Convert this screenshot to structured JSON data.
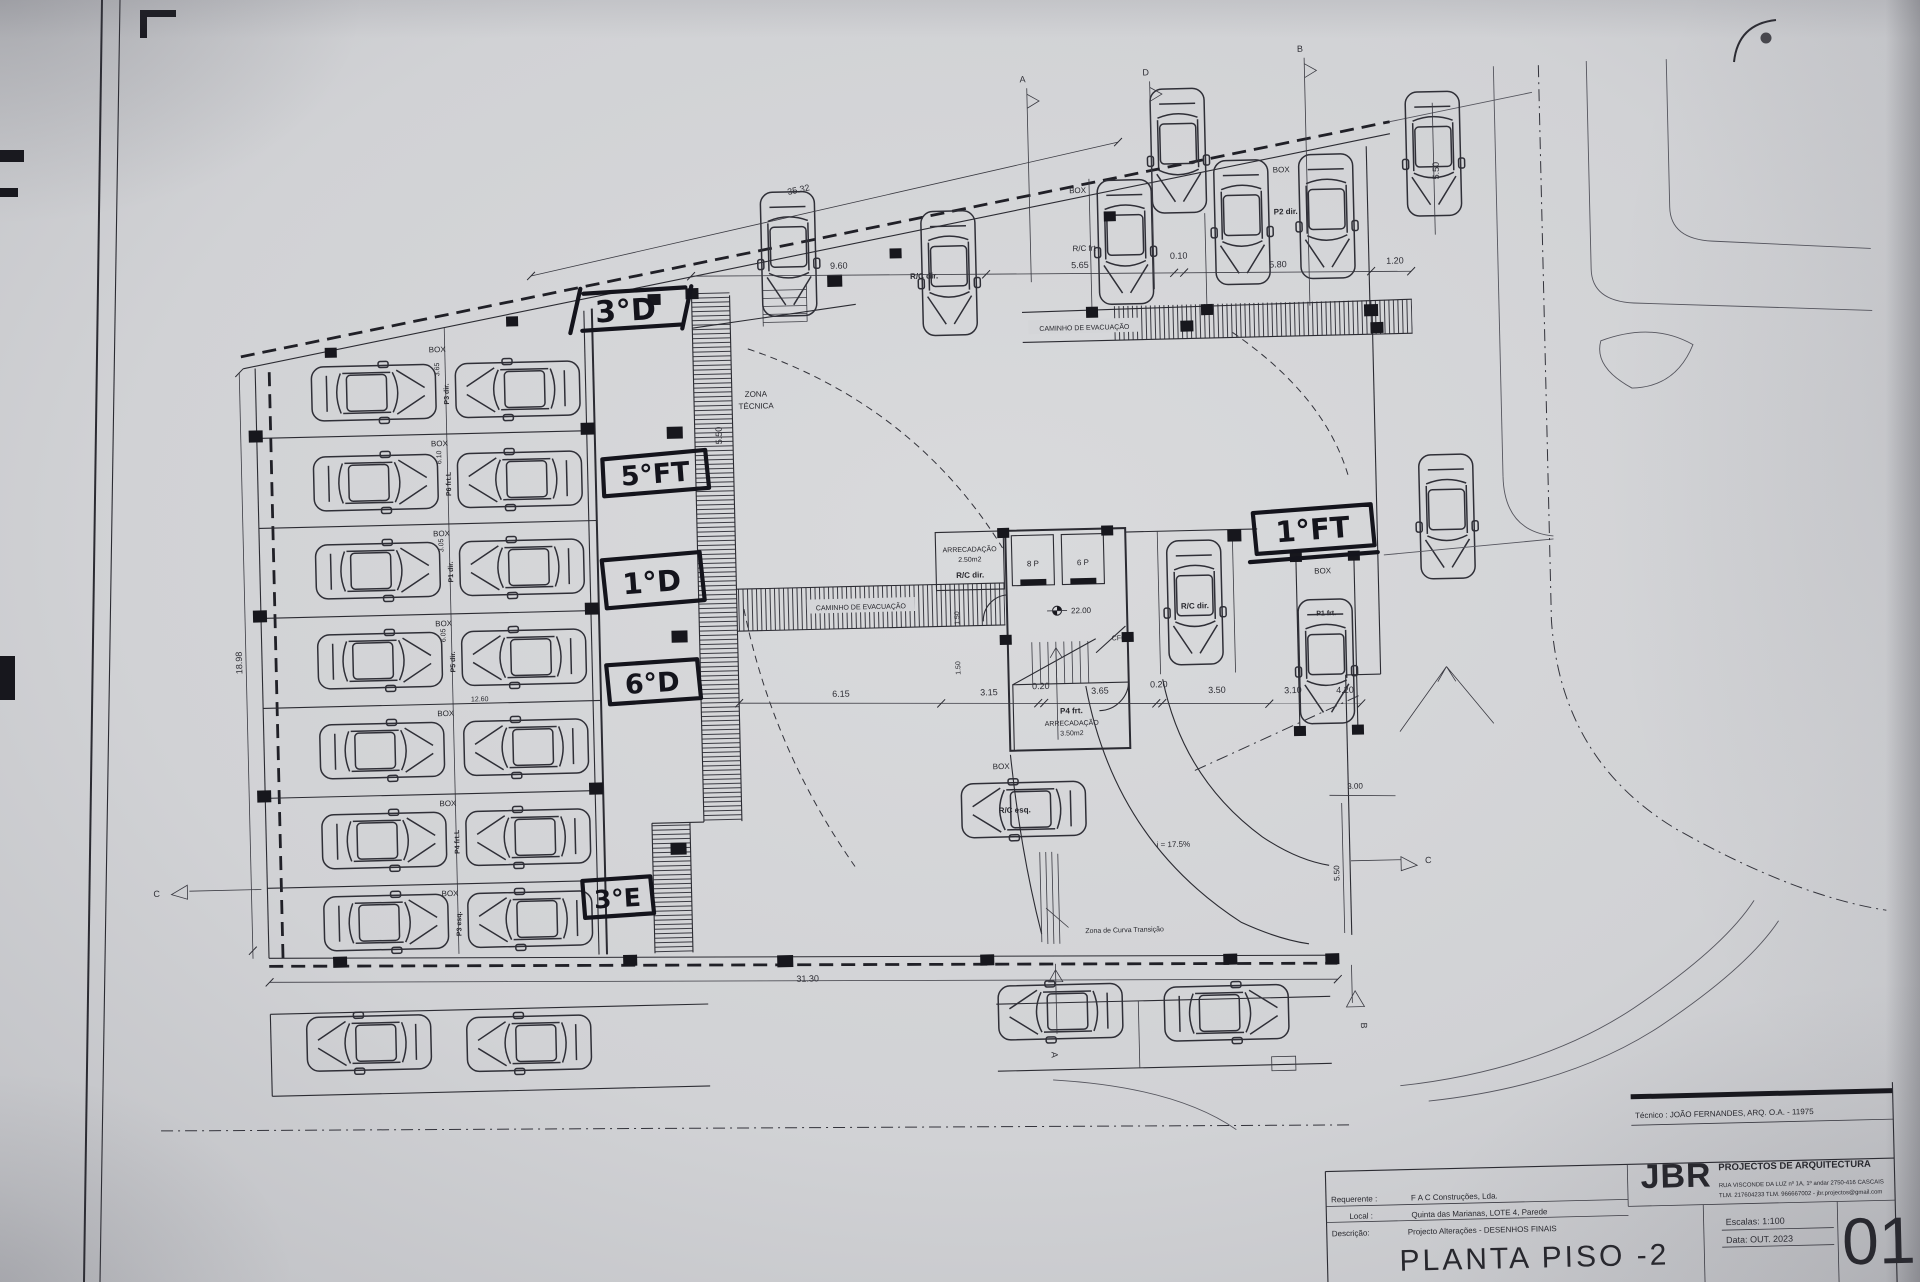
{
  "sheet": {
    "title_block": {
      "tecnico": "Técnico : JOÃO FERNANDES, ARQ.   O.A. - 11975",
      "firm_abbr": "JBR",
      "firm_name": "PROJECTOS DE ARQUITECTURA",
      "firm_address": "RUA VISCONDE DA LUZ nº 1A, 1º andar  2750-416  CASCAIS",
      "firm_contacts": "TLM. 217604233  TLM. 966667002 - jbr.projectos@gmail.com",
      "requerente_label": "Requerente :",
      "requerente": "F A C  Construções, Lda.",
      "local_label": "Local :",
      "local": "Quinta das Marianas, LOTE 4, Parede",
      "descricao_label": "Descrição:",
      "descricao": "Projecto Alterações - DESENHOS FINAIS",
      "drawing_title": "PLANTA PISO -2",
      "escalas": "Escalas:  1:100",
      "data": "Data: OUT.  2023",
      "sheet_number": "01"
    },
    "handwritten": {
      "n1": "3°D",
      "n2": "5°FT",
      "n3": "1°D",
      "n4": "6°D",
      "n5": "3°E",
      "n6": "1°FT"
    },
    "plan": {
      "box": "BOX",
      "zona1": "ZONA",
      "zona2": "TÉCNICA",
      "caminho": "CAMINHO DE EVACUAÇÃO",
      "arrecadacao": "ARRECADAÇÃO",
      "area250": "2.50m2",
      "area350": "3.50m2",
      "rc_dir": "R/C dir.",
      "rc_esq": "R/C esq.",
      "rc_frt": "R/C frt",
      "p2_dir": "P2 dir.",
      "p4_frt": "P4 frt.",
      "p1_frt": "P1 frt.",
      "lift8": "8 P",
      "lift6": "6 P",
      "cf60": "CF60",
      "slope": "i = 17.5%",
      "curva": "Zona de Curva Transição",
      "plates": [
        "P3 dir.",
        "P6 frt.L",
        "P1 dir.",
        "P5 dir.",
        "P4 frt.L",
        "P3 esq."
      ]
    },
    "dims": {
      "d3532": "35.32",
      "d960": "9.60",
      "d565": "5.65",
      "d010": "0.10",
      "d580": "5.80",
      "d120": "1.20",
      "d550": "5.50",
      "d1898": "18.98",
      "d1260": "12.60",
      "d615": "6.15",
      "d315": "3.15",
      "d020": "0.20",
      "d365": "3.65",
      "d350": "3.50",
      "d310": "3.10",
      "d420": "4.20",
      "d300": "3.00",
      "d3130": "31.30",
      "d150": "1.50",
      "d2200": "22.00",
      "d305": "3.05",
      "d610": "6.10",
      "d605": "6.05"
    },
    "sections": {
      "a": "A",
      "b": "B",
      "c": "C",
      "d": "D"
    }
  }
}
